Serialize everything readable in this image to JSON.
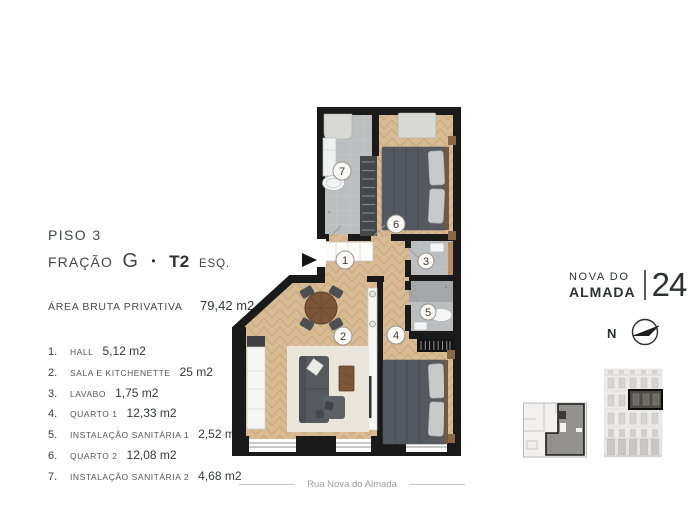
{
  "header": {
    "floor": "PISO 3",
    "fraction_label": "FRAÇÃO",
    "fraction_value": "G",
    "bullet": "•",
    "typology": "T2",
    "typology_suffix": "ESQ."
  },
  "area": {
    "label": "ÁREA BRUTA PRIVATIVA",
    "value": "79,42 m2"
  },
  "rooms": [
    {
      "index": "1.",
      "plan_num": "1",
      "name": "HALL",
      "area": "5,12 m2"
    },
    {
      "index": "2.",
      "plan_num": "2",
      "name": "SALA E KITCHENETTE",
      "area": "25 m2"
    },
    {
      "index": "3.",
      "plan_num": "3",
      "name": "LAVABO",
      "area": "1,75 m2"
    },
    {
      "index": "4.",
      "plan_num": "4",
      "name": "QUARTO 1",
      "area": "12,33 m2"
    },
    {
      "index": "5.",
      "plan_num": "5",
      "name": "INSTALAÇÃO SANITÁRIA 1",
      "area": "2,52 m2"
    },
    {
      "index": "6.",
      "plan_num": "6",
      "name": "QUARTO 2",
      "area": "12,08 m2"
    },
    {
      "index": "7.",
      "plan_num": "7",
      "name": "INSTALAÇÃO SANITÁRIA 2",
      "area": "4,68 m2"
    }
  ],
  "brand": {
    "line1": "NOVA DO",
    "line2": "ALMADA",
    "number": "24"
  },
  "compass": {
    "north_label": "N"
  },
  "street": {
    "name": "Rua Nova do Almada"
  },
  "colors": {
    "wall": "#1a1a1a",
    "wood_floor": "#d8bb94",
    "tile_floor": "#bbbebf",
    "furniture_gray": "#565a5f",
    "rug": "#eae5da",
    "table_wood": "#7b563a",
    "text_dark": "#2f3034",
    "text_muted": "#9d9d9d"
  }
}
